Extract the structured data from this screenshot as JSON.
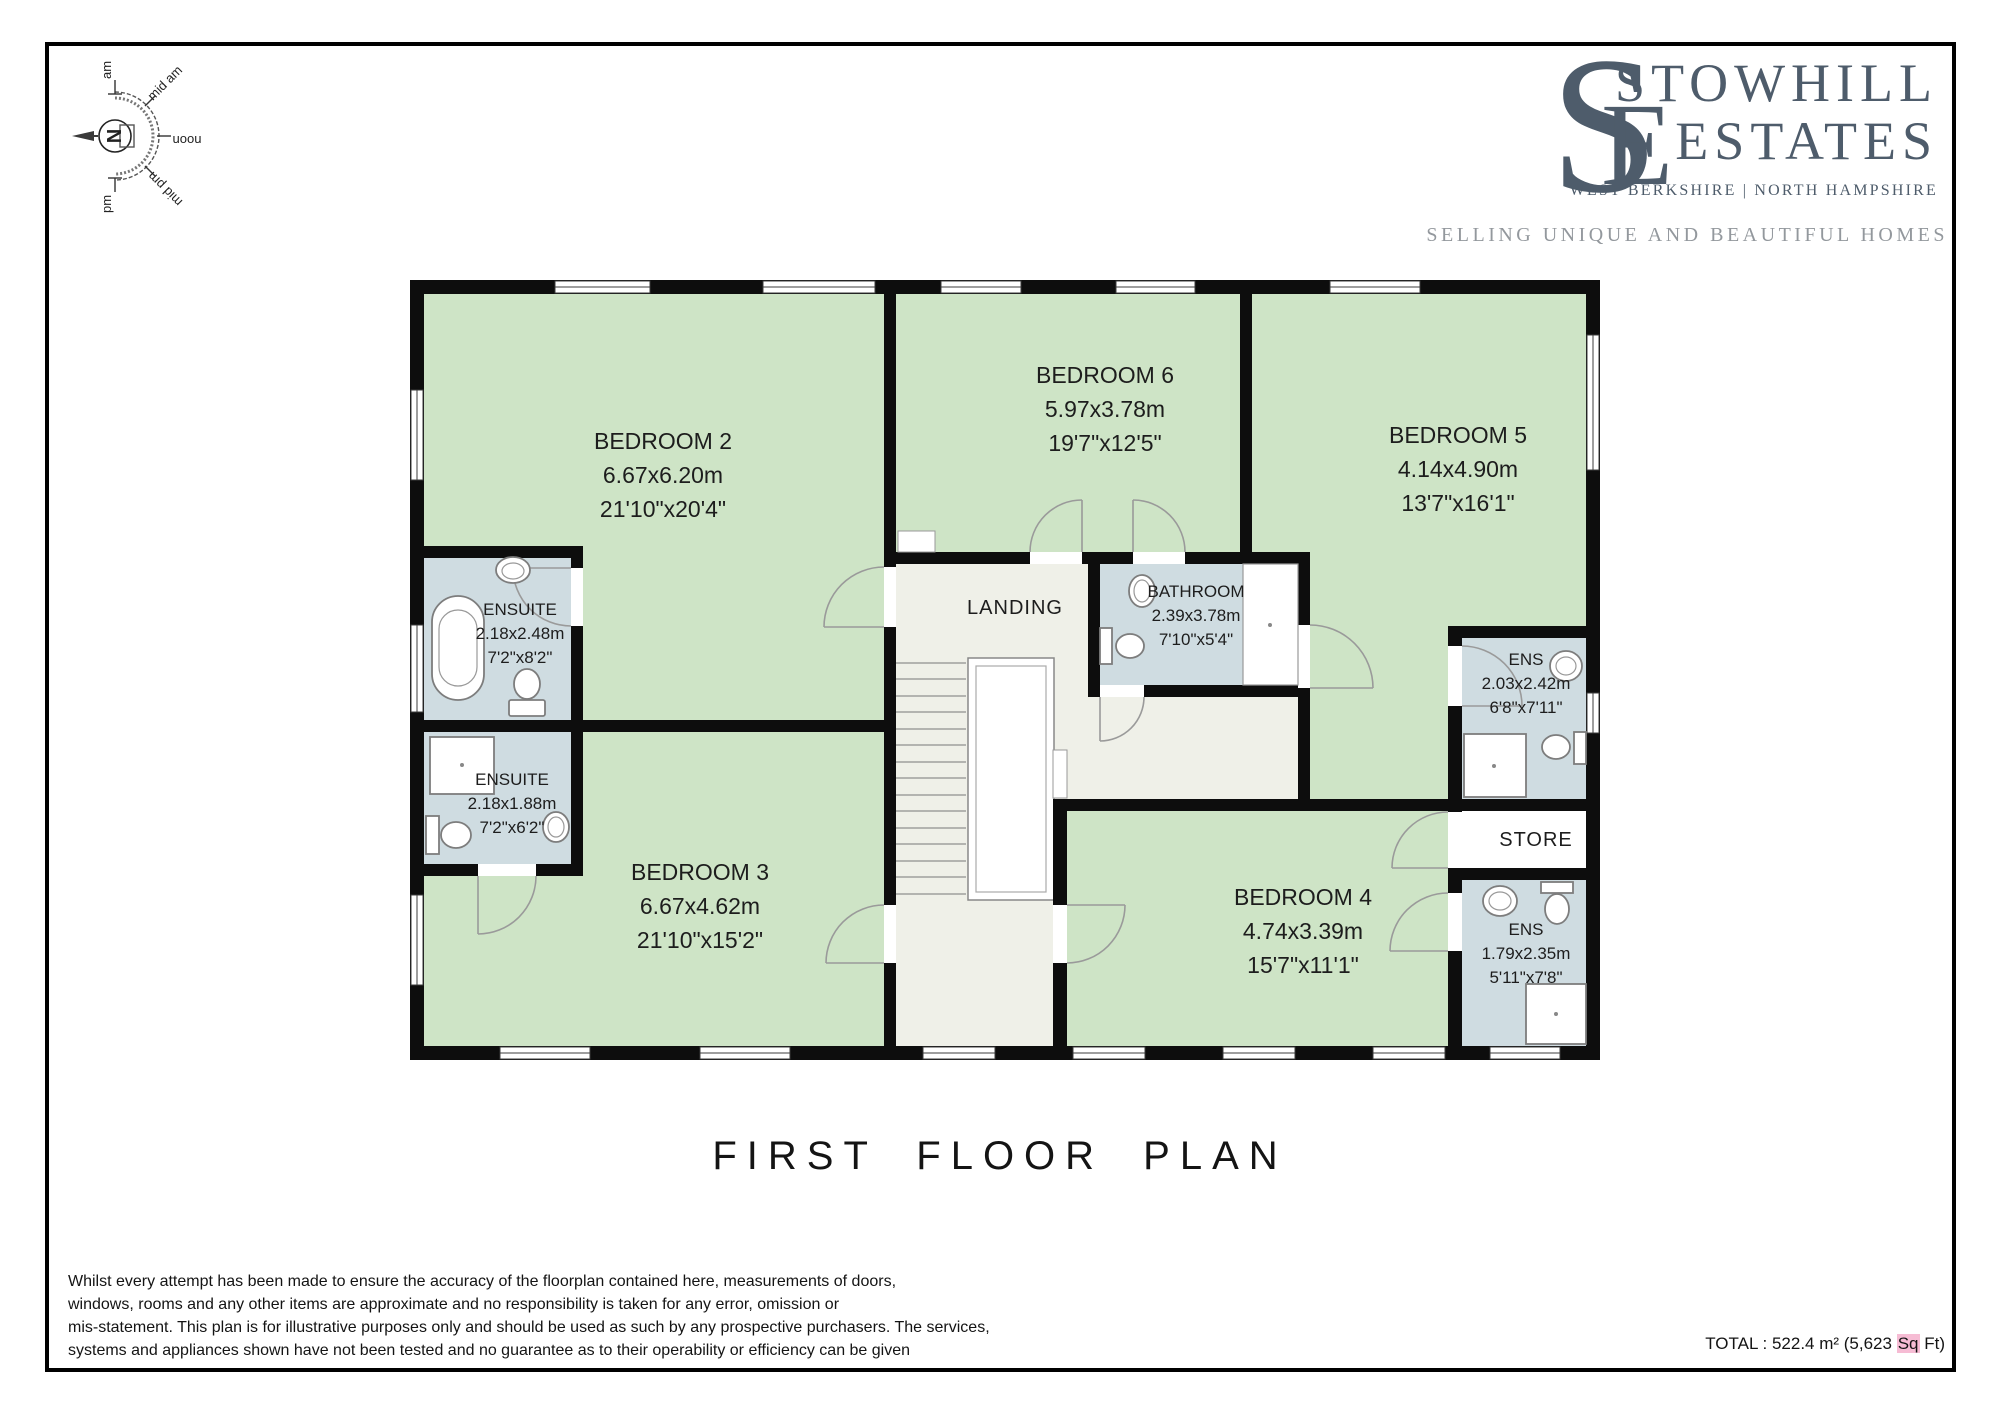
{
  "branding": {
    "monogram_s": "S",
    "monogram_e": "E",
    "name_line1": "STOWHILL",
    "name_line2": "ESTATES",
    "region": "WEST BERKSHIRE | NORTH HAMPSHIRE",
    "tagline": "SELLING UNIQUE AND BEAUTIFUL HOMES",
    "brand_color": "#4e5c6b",
    "tagline_color": "#93989d"
  },
  "compass": {
    "north_label": "N",
    "sun_labels": [
      "am",
      "mid am",
      "noon",
      "mid pm",
      "pm"
    ]
  },
  "plan": {
    "title": "FIRST FLOOR PLAN",
    "rooms": {
      "bedroom2": {
        "name": "BEDROOM 2",
        "metric": "6.67x6.20m",
        "imperial": "21'10\"x20'4\""
      },
      "bedroom3": {
        "name": "BEDROOM 3",
        "metric": "6.67x4.62m",
        "imperial": "21'10\"x15'2\""
      },
      "bedroom4": {
        "name": "BEDROOM 4",
        "metric": "4.74x3.39m",
        "imperial": "15'7\"x11'1\""
      },
      "bedroom5": {
        "name": "BEDROOM 5",
        "metric": "4.14x4.90m",
        "imperial": "13'7\"x16'1\""
      },
      "bedroom6": {
        "name": "BEDROOM 6",
        "metric": "5.97x3.78m",
        "imperial": "19'7\"x12'5\""
      },
      "ensuite1": {
        "name": "ENSUITE",
        "metric": "2.18x2.48m",
        "imperial": "7'2\"x8'2\""
      },
      "ensuite2": {
        "name": "ENSUITE",
        "metric": "2.18x1.88m",
        "imperial": "7'2\"x6'2\""
      },
      "bathroom": {
        "name": "BATHROOM",
        "metric": "2.39x3.78m",
        "imperial": "7'10\"x5'4\""
      },
      "ens_right": {
        "name": "ENS",
        "metric": "2.03x2.42m",
        "imperial": "6'8\"x7'11\""
      },
      "ens_bottom": {
        "name": "ENS",
        "metric": "1.79x2.35m",
        "imperial": "5'11\"x7'8\""
      },
      "store": {
        "name": "STORE"
      },
      "landing": {
        "name": "LANDING"
      }
    },
    "colors": {
      "wall": "#0d0d0d",
      "room_green": "#cee4c6",
      "bath_blue": "#cfdce1",
      "landing_cream": "#eff0e8",
      "highlight_pink": "#f6bcd4"
    }
  },
  "footer": {
    "disclaimer_lines": [
      "Whilst every attempt has been made to ensure the accuracy of the floorplan contained here, measurements of doors,",
      "windows, rooms and any other items are approximate and no responsibility is taken for any error, omission or",
      "mis-statement. This plan is for illustrative purposes only and should be used as such by any prospective purchasers. The services,",
      "systems and appliances shown have not been tested and no guarantee as to their operability or efficiency can be given"
    ],
    "total_prefix": "TOTAL : 522.4 m² (5,623 ",
    "total_highlight": "Sq",
    "total_suffix": " Ft)"
  }
}
